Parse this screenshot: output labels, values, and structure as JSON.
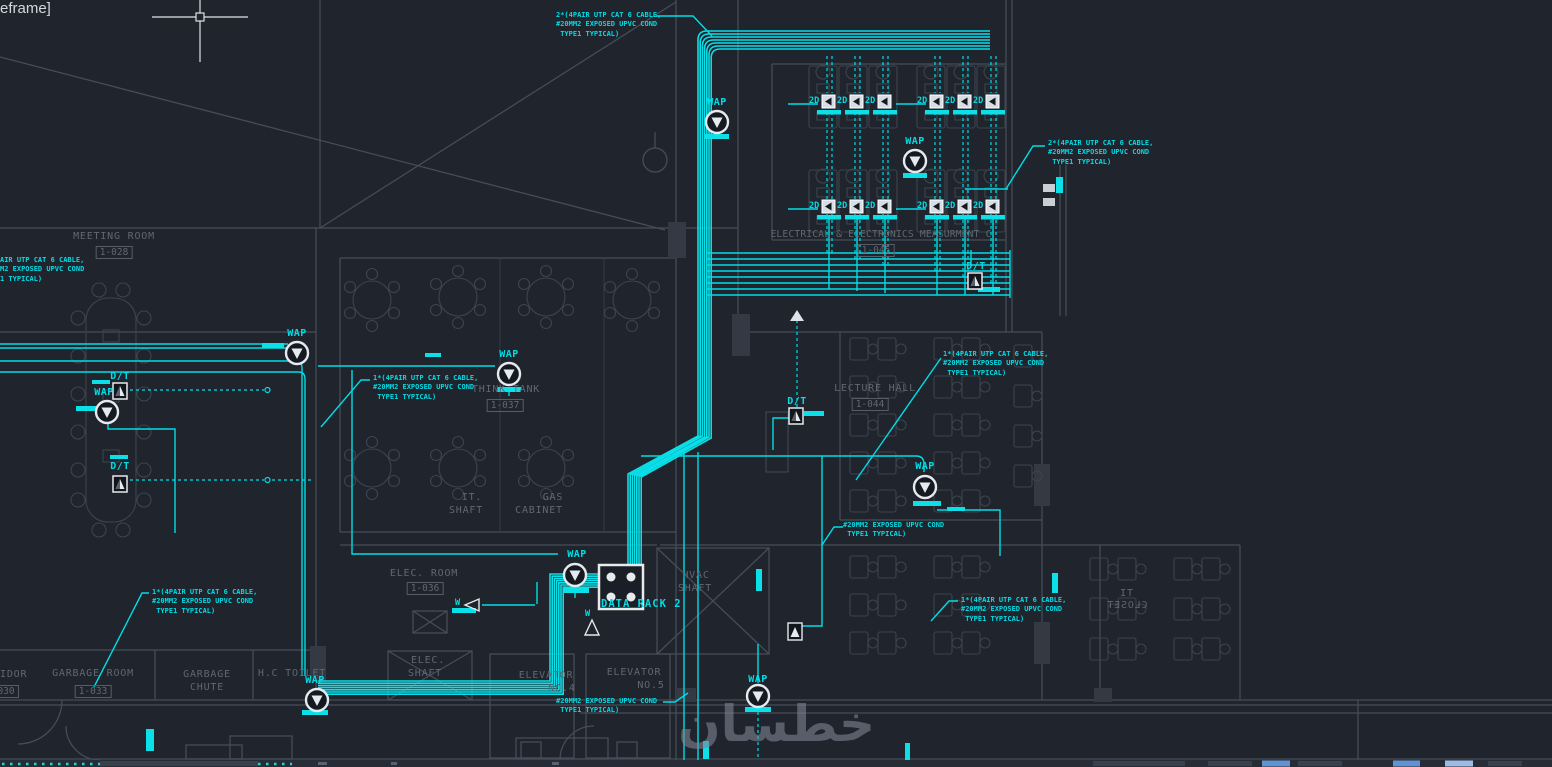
{
  "viewport": {
    "overlay_label": "eframe]"
  },
  "watermark": {
    "text": "خطسان"
  },
  "symbols": {
    "wap": "WAP",
    "dt": "D/T",
    "outlet": "2D",
    "wall_outlet": "W",
    "data_rack": "DATA RACK 2"
  },
  "annotations": {
    "cable_top": "2*(4PAIR UTP CAT 6 CABLE,\n#20MM2 EXPOSED UPVC COND\n TYPE1 TYPICAL)",
    "cable_right_top": "2*(4PAIR UTP CAT 6 CABLE,\n#20MM2 EXPOSED UPVC COND\n TYPE1 TYPICAL)",
    "cable_left_clipped": "AIR UTP CAT 6 CABLE,\nM2 EXPOSED UPVC COND\n1 TYPICAL)",
    "cable_think_tank": "1*(4PAIR UTP CAT 6 CABLE,\n#20MM2 EXPOSED UPVC COND\n TYPE1 TYPICAL)",
    "cable_lecture_hall": "1*(4PAIR UTP CAT 6 CABLE,\n#20MM2 EXPOSED UPVC COND\n TYPE1 TYPICAL)",
    "cond_mid": "#20MM2 EXPOSED UPVC COND\n TYPE1 TYPICAL)",
    "cable_it_closet": "1*(4PAIR UTP CAT 6 CABLE,\n#20MM2 EXPOSED UPVC COND\n TYPE1 TYPICAL)",
    "cable_garbage": "1*(4PAIR UTP CAT 6 CABLE,\n#20MM2 EXPOSED UPVC COND\n TYPE1 TYPICAL)",
    "cond_elevator": "#20MM2 EXPOSED UPVC COND\n TYPE1 TYPICAL)"
  },
  "rooms": {
    "meeting_room": {
      "name": "MEETING ROOM",
      "number": "1-028"
    },
    "think_tank": {
      "name": "THINK TANK",
      "number": "1-037"
    },
    "measurement": {
      "name": "ELECTRICAL & ELECTRONICS MEASURMENT C",
      "number": "1-045"
    },
    "lecture_hall": {
      "name": "LECTURE HALL",
      "number": "1-044"
    },
    "elec_room": {
      "name": "ELEC. ROOM",
      "number": "1-036"
    },
    "it_shaft": {
      "line1": "IT.",
      "line2": "SHAFT"
    },
    "gas_cabinet": {
      "line1": "GAS",
      "line2": "CABINET"
    },
    "hvac_shaft": {
      "line1": "HVAC",
      "line2": "SHAFT"
    },
    "elec_shaft": {
      "line1": "ELEC.",
      "line2": "SHAFT"
    },
    "elevator_no4": {
      "line1": "ELEVATOR",
      "line2": "NO.4"
    },
    "elevator_no5": {
      "line1": "ELEVATOR",
      "line2": "NO.5"
    },
    "garbage_room": {
      "name": "GARBAGE ROOM",
      "number": "1-033"
    },
    "garbage_chute": {
      "line1": "GARBAGE",
      "line2": "CHUTE"
    },
    "hc_toilet": {
      "name": "H.C TOILET"
    },
    "corridor": {
      "name": "IDOR",
      "number": "1-030"
    },
    "it_closet": {
      "line1": "IT",
      "line2": "CLOSET"
    }
  },
  "colors": {
    "cable": "#00dde6",
    "wall": "#464d57",
    "background": "#1f242d",
    "symbol_white": "#e6e9ed",
    "status_accent": "#6093d3"
  }
}
